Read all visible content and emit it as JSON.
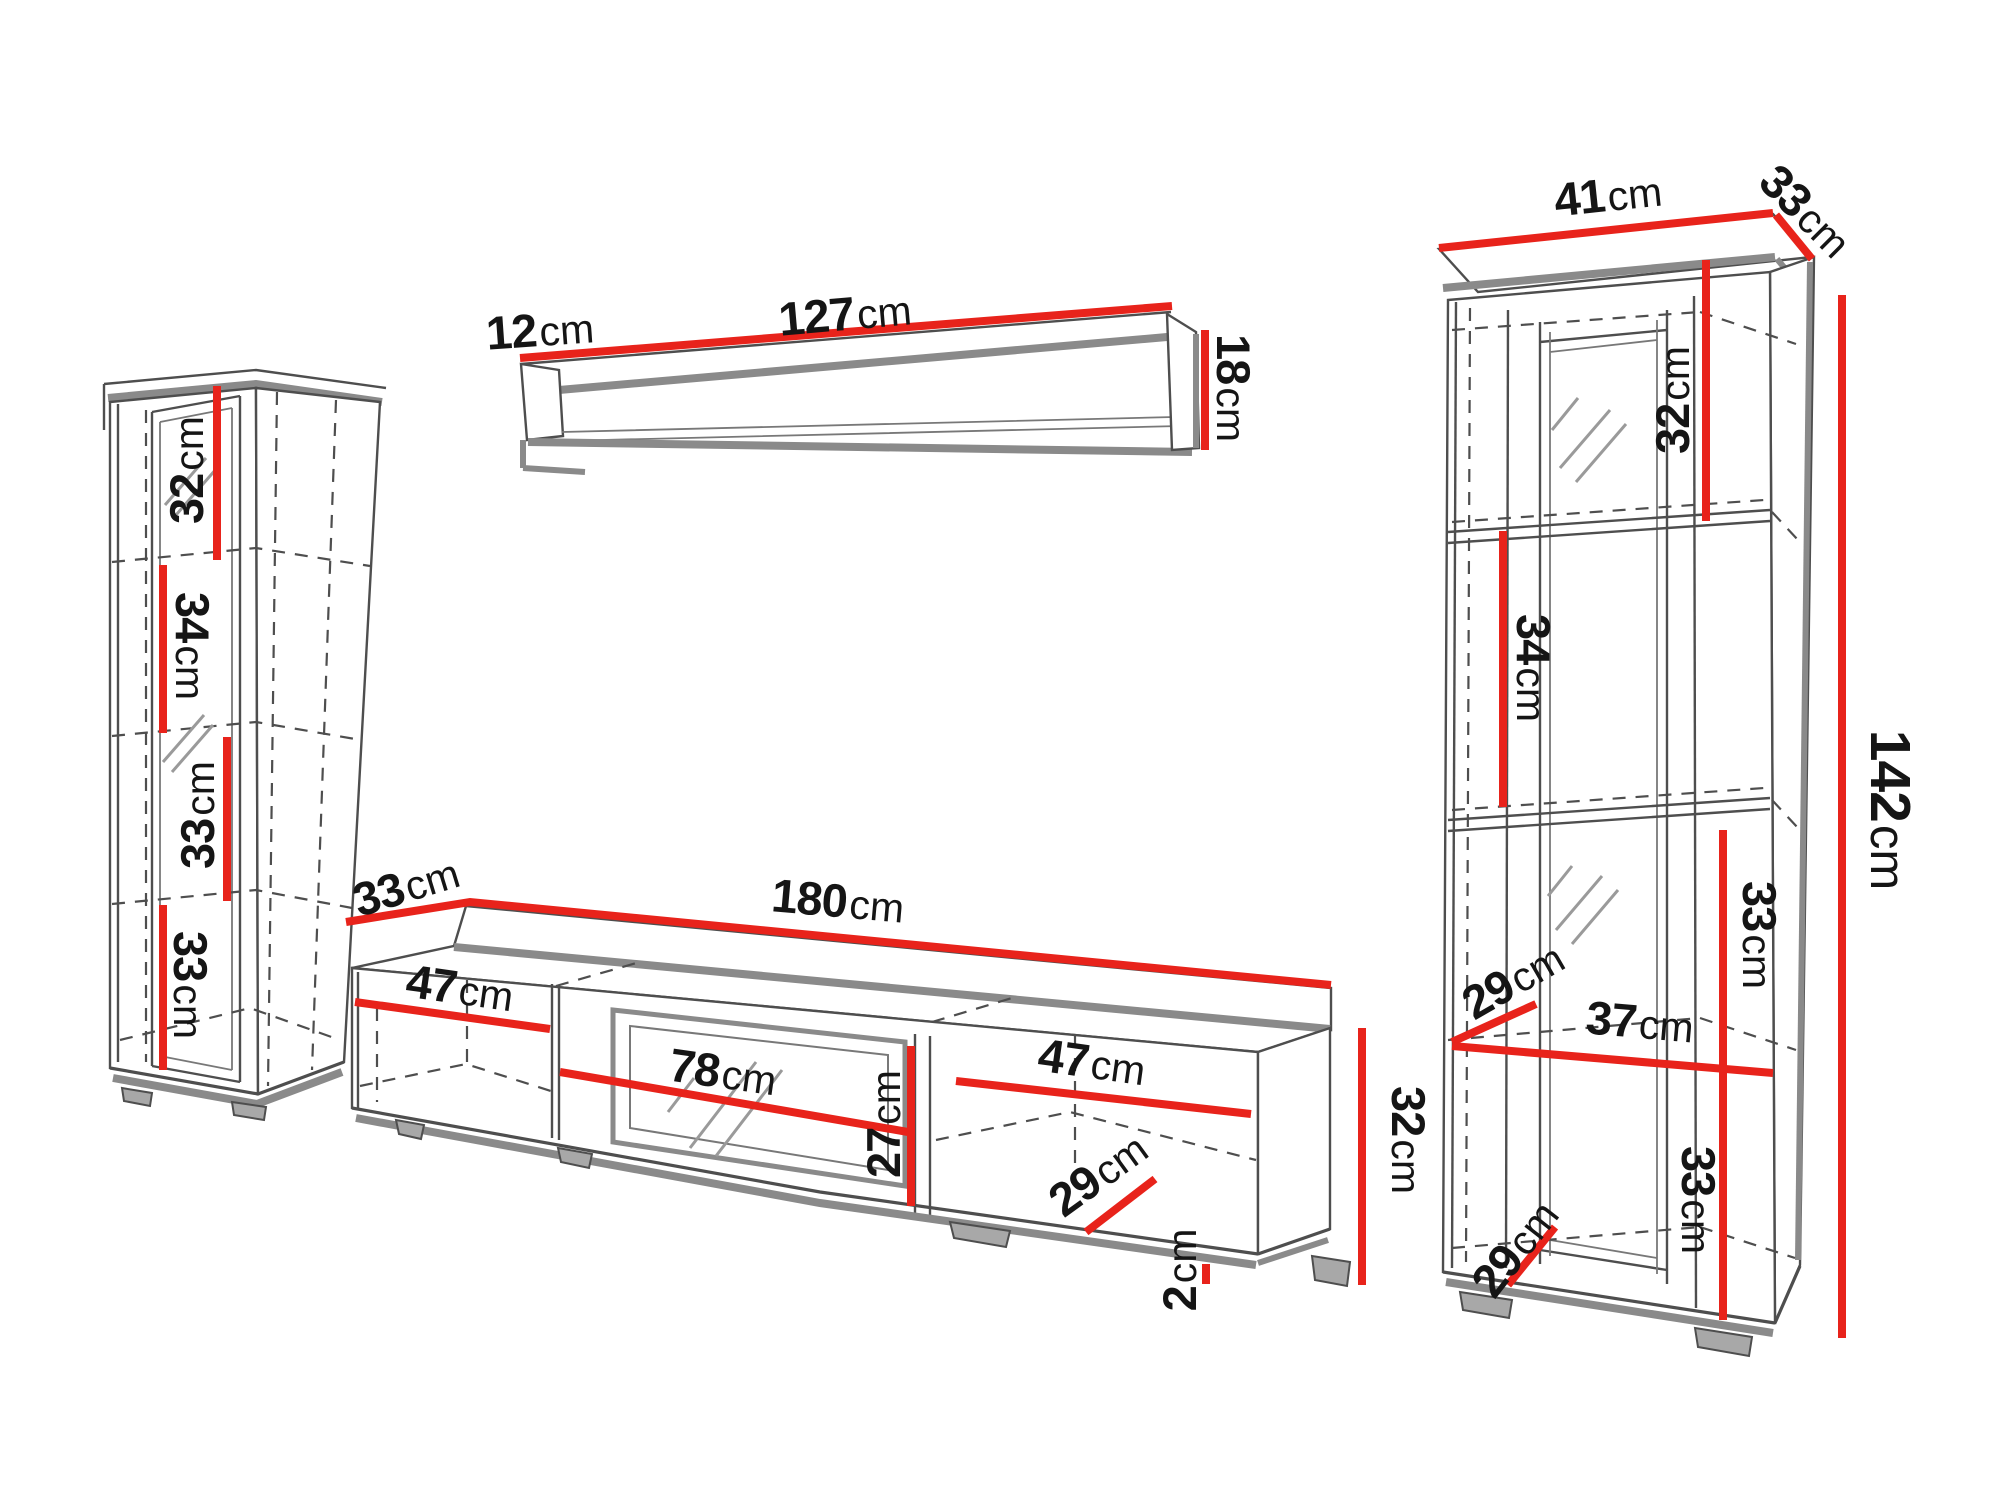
{
  "diagram_type": "furniture wall-unit dimension drawing",
  "unit": "cm",
  "colors": {
    "dimension_line": "#e8231b",
    "outline": "#4e4e4e",
    "panel_edge": "#8a8a8a",
    "label_text": "#151515",
    "background": "#ffffff"
  },
  "pieces": {
    "left_display_cabinet": {
      "sections": {
        "s1": {
          "value": "32",
          "unit": "cm"
        },
        "s2": {
          "value": "34",
          "unit": "cm"
        },
        "s3": {
          "value": "33",
          "unit": "cm"
        },
        "s4": {
          "value": "33",
          "unit": "cm"
        }
      }
    },
    "wall_shelf": {
      "side_depth": {
        "value": "12",
        "unit": "cm"
      },
      "width": {
        "value": "127",
        "unit": "cm"
      },
      "height": {
        "value": "18",
        "unit": "cm"
      }
    },
    "tv_stand": {
      "top_depth": {
        "value": "33",
        "unit": "cm"
      },
      "width": {
        "value": "180",
        "unit": "cm"
      },
      "left_compartment_width": {
        "value": "47",
        "unit": "cm"
      },
      "middle_compartment_width": {
        "value": "78",
        "unit": "cm"
      },
      "middle_compartment_height": {
        "value": "27",
        "unit": "cm"
      },
      "right_compartment_width": {
        "value": "47",
        "unit": "cm"
      },
      "compartment_depth": {
        "value": "29",
        "unit": "cm"
      },
      "plinth_height": {
        "value": "2",
        "unit": "cm"
      },
      "height": {
        "value": "32",
        "unit": "cm"
      }
    },
    "right_display_cabinet": {
      "width": {
        "value": "41",
        "unit": "cm"
      },
      "top_depth": {
        "value": "33",
        "unit": "cm"
      },
      "height": {
        "value": "142",
        "unit": "cm"
      },
      "sections": {
        "s1": {
          "value": "32",
          "unit": "cm"
        },
        "s2": {
          "value": "34",
          "unit": "cm"
        },
        "s3": {
          "value": "33",
          "unit": "cm"
        },
        "s4": {
          "value": "33",
          "unit": "cm"
        }
      },
      "shelf_clear_depth_upper": {
        "value": "29",
        "unit": "cm"
      },
      "interior_width": {
        "value": "37",
        "unit": "cm"
      },
      "shelf_clear_depth_lower": {
        "value": "29",
        "unit": "cm"
      }
    }
  }
}
